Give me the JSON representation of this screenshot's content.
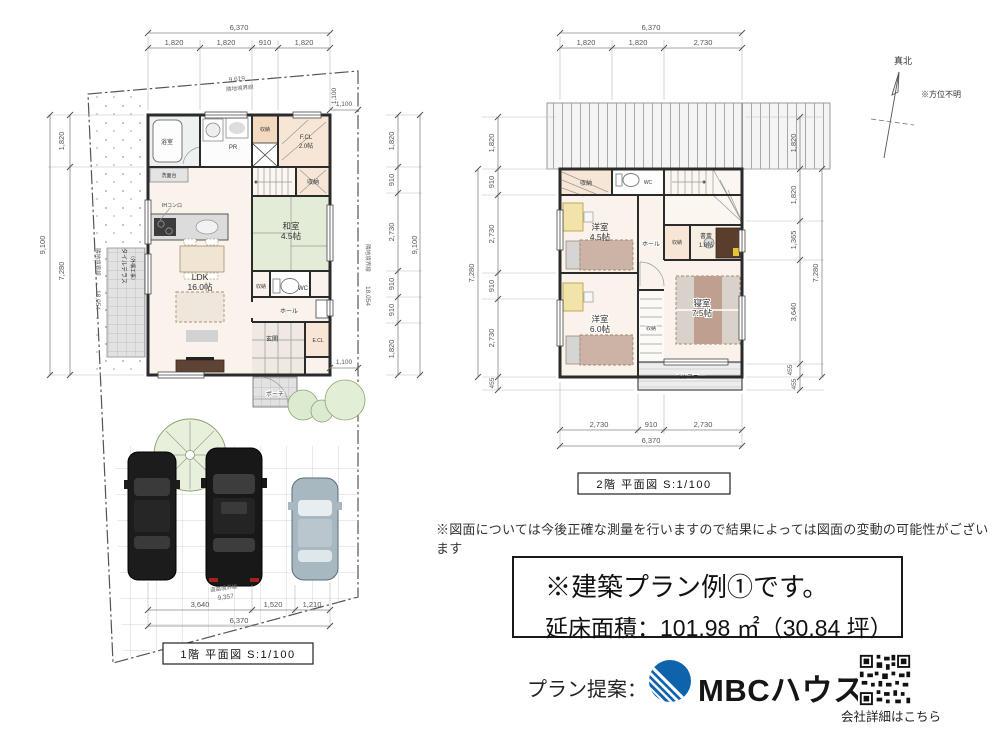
{
  "compass": {
    "north": "真北",
    "note": "※方位不明"
  },
  "disclaimer": "※図面については今後正確な測量を行いますので結果によっては図面の変動の可能性がございます",
  "info_box": {
    "line1": "※建築プラン例①です。",
    "line2": "延床面積：101.98 ㎡（30.84 坪）"
  },
  "footer": {
    "label": "プラン提案：",
    "brand": "MBCハウス",
    "qr_caption": "会社詳細はこちら"
  },
  "brand_color": "#0f62ac",
  "plan1f": {
    "caption": "1階 平面図 S:1/100",
    "boundaries": {
      "top_len": "9,619",
      "top_name": "隣地境界線",
      "left_len": "18,054",
      "left_name": "隣地境界線",
      "right_len": "18,054",
      "right_name": "隣地境界線",
      "bottom_len": "9,357",
      "bottom_name": "道路境界線"
    },
    "dims": {
      "top_total": "6,370",
      "top": [
        "1,820",
        "1,820",
        "910",
        "1,820"
      ],
      "left": [
        "1,820",
        "7,280"
      ],
      "left_total": "9,100",
      "right": [
        "1,820",
        "910",
        "2,730",
        "910",
        "910",
        "1,820"
      ],
      "right_total": "9,100",
      "bottom": [
        "3,640",
        "1,520",
        "1,210"
      ],
      "bottom_total": "6,370",
      "offset_a": "1,100",
      "offset_b": "1,100",
      "offset_c": "1,100"
    },
    "rooms": {
      "bath": "浴室",
      "pr": "PR",
      "closet_top": "収納",
      "fcl": "F.CL",
      "fcl_size": "2.0帖",
      "closet_stair": "収納",
      "washitsu": "和室",
      "washitsu_size": "4.5帖",
      "ldk": "LDK",
      "ldk_size": "16.0帖",
      "ih": "IHコンロ",
      "vanity": "洗面台",
      "closet_hall": "収納",
      "wc": "WC",
      "hall": "ホール",
      "genkan": "玄関",
      "ecl": "E.CL",
      "porch": "ポーチ",
      "terrace_1": "タイルテラス",
      "terrace_2": "（外構工事）"
    }
  },
  "plan2f": {
    "caption": "2階 平面図 S:1/100",
    "dims": {
      "top_total": "6,370",
      "top": [
        "1,820",
        "1,820",
        "2,730"
      ],
      "left": [
        "1,820",
        "910",
        "2,730",
        "910",
        "2,730",
        "455"
      ],
      "left_total": "7,280",
      "right": [
        "1,820",
        "1,820",
        "1,365",
        "3,640",
        "455",
        "455"
      ],
      "right_total": "7,280",
      "bottom": [
        "2,730",
        "910",
        "2,730"
      ],
      "bottom_total": "6,370"
    },
    "rooms": {
      "closet_top": "収納",
      "wc": "WC",
      "hall": "ホール",
      "closet_mid": "収納",
      "study": "書斎",
      "study_size": "1.8帖",
      "yo45": "洋室",
      "yo45_size": "4.5帖",
      "yo60": "洋室",
      "yo60_size": "6.0帖",
      "bedroom": "寝室",
      "bedroom_size": "7.5帖",
      "closet_low": "収納",
      "balcony": "バルコニー"
    }
  }
}
